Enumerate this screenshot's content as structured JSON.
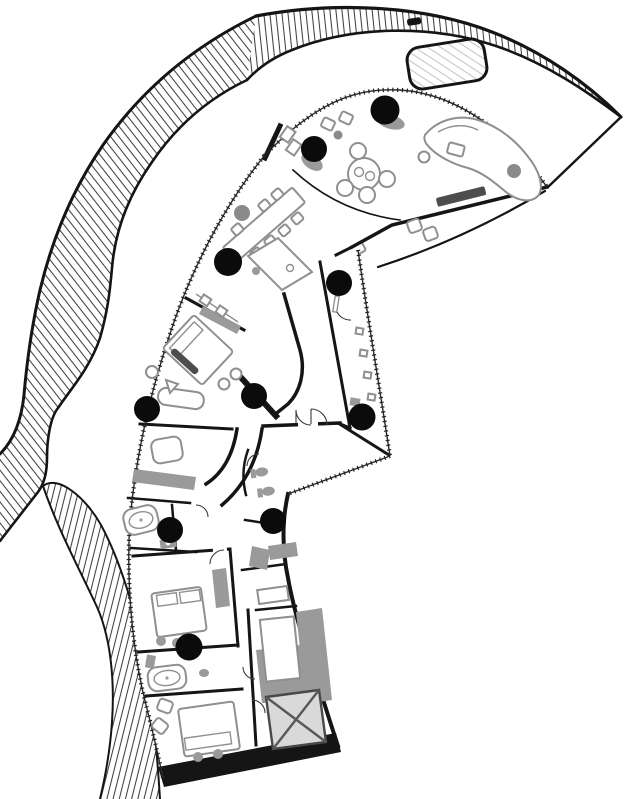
{
  "meta": {
    "title": "curved-penthouse-floor-plan",
    "type": "architectural-floor-plan"
  },
  "canvas": {
    "width": 624,
    "height": 799
  },
  "colors": {
    "background": "#ffffff",
    "wall": "#151515",
    "furniture_line": "#8f8f8f",
    "gray_fill": "#9a9a9a",
    "light_gray_fill": "#d9d9d9",
    "hatch_line": "#3f3f3f",
    "spa_hatch": "#c6c6c6",
    "marker_black": "#0b0b0b",
    "marker_gray": "#8a8a8a"
  },
  "markers": {
    "columns_black": [
      {
        "x": 385,
        "y": 110,
        "r": 14.5
      },
      {
        "x": 314,
        "y": 149,
        "r": 13
      },
      {
        "x": 228,
        "y": 262,
        "r": 14
      },
      {
        "x": 339,
        "y": 283,
        "r": 13
      },
      {
        "x": 147,
        "y": 409,
        "r": 13
      },
      {
        "x": 254,
        "y": 396,
        "r": 13
      },
      {
        "x": 362,
        "y": 417,
        "r": 13.5
      },
      {
        "x": 170,
        "y": 530,
        "r": 13
      },
      {
        "x": 273,
        "y": 521,
        "r": 13
      },
      {
        "x": 189,
        "y": 647,
        "r": 13.5
      }
    ],
    "points_gray": [
      {
        "x": 242,
        "y": 213,
        "r": 8
      },
      {
        "x": 514,
        "y": 171,
        "r": 7
      },
      {
        "x": 338,
        "y": 135,
        "r": 4.5
      }
    ]
  },
  "features": {
    "black_circle_markers": 10,
    "gray_circle_markers": 3,
    "beds": 3,
    "bathtubs": 2,
    "dining_chairs": 7,
    "round_table_chairs": 4,
    "elevator_with_x": true,
    "spa_rounded_rect": true
  }
}
